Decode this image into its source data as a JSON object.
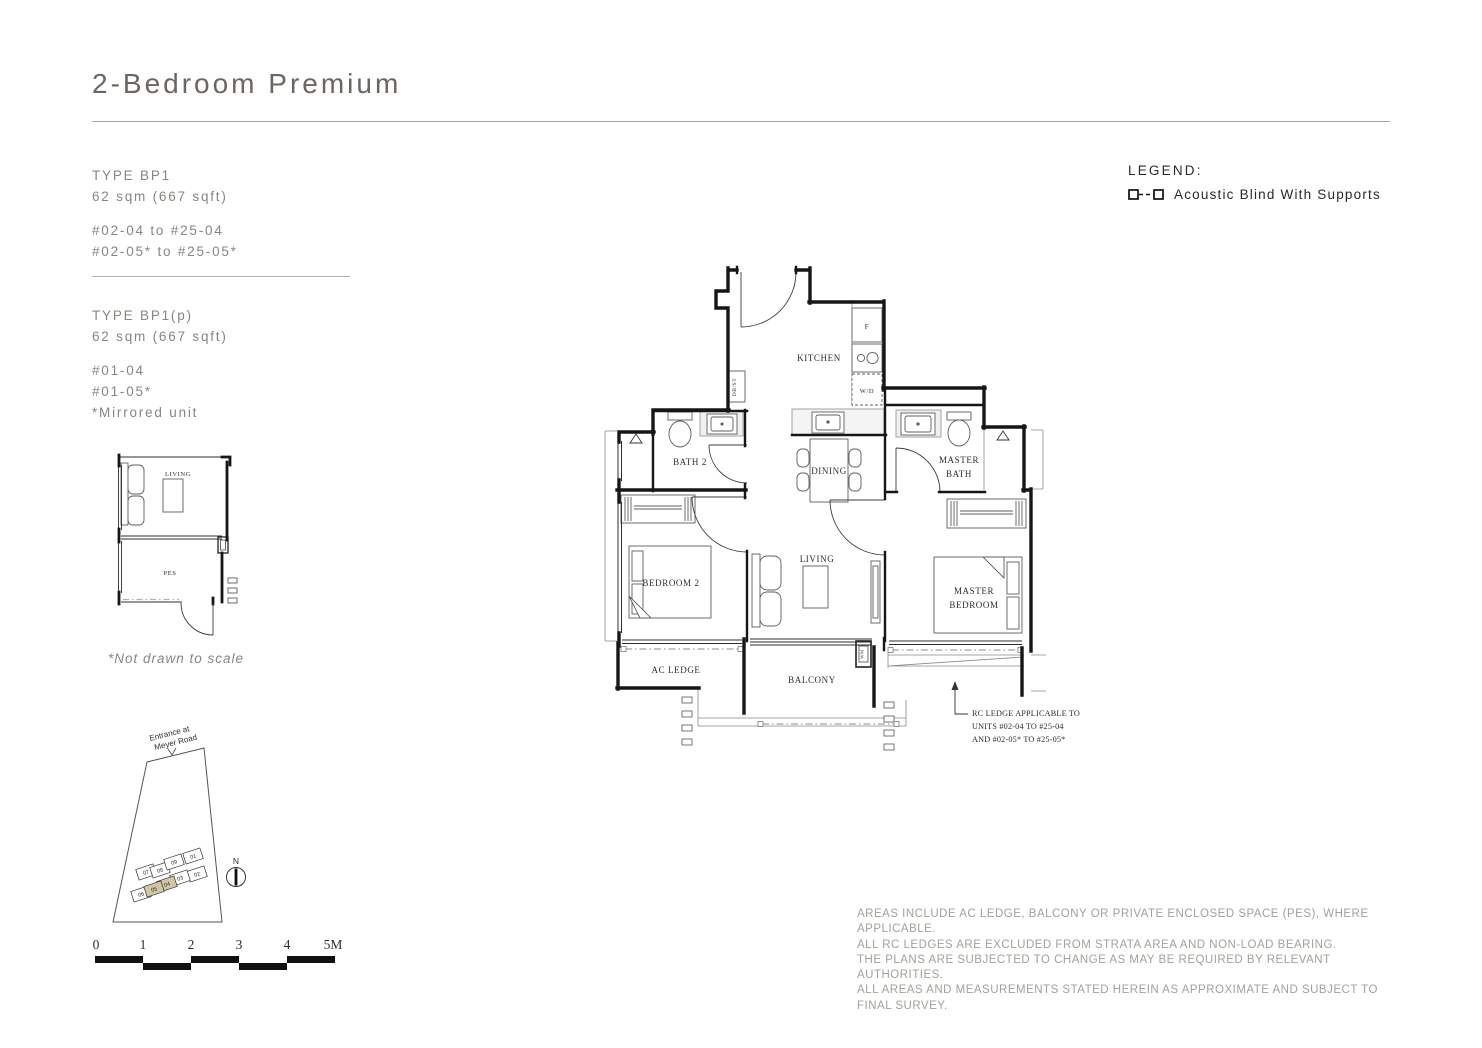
{
  "header": {
    "title": "2-Bedroom Premium"
  },
  "unit_types": [
    {
      "name": "TYPE BP1",
      "area": "62 sqm (667 sqft)",
      "units": [
        "#02-04 to #25-04",
        "#02-05* to #25-05*"
      ]
    },
    {
      "name": "TYPE BP1(p)",
      "area": "62 sqm (667 sqft)",
      "units": [
        "#01-04",
        "#01-05*"
      ],
      "note": "*Mirrored unit"
    }
  ],
  "legend": {
    "title": "LEGEND:",
    "item_label": "Acoustic Blind With Supports"
  },
  "floor_plan": {
    "rooms": {
      "kitchen": "KITCHEN",
      "bath2": "BATH 2",
      "dining": "DINING",
      "master_bath": [
        "MASTER",
        "BATH"
      ],
      "bedroom2": "BEDROOM 2",
      "living": "LIVING",
      "master_bedroom": [
        "MASTER",
        "BEDROOM"
      ],
      "ac_ledge": "AC LEDGE",
      "balcony": "BALCONY"
    },
    "fixtures": {
      "fridge": "F",
      "washer_dryer": "W/D",
      "db_st": "DB/ST",
      "wm": "WM"
    },
    "callout": {
      "lines": [
        "RC LEDGE APPLICABLE TO",
        "UNITS #02-04 TO #25-04",
        "AND #02-05* TO #25-05*"
      ]
    }
  },
  "inset_plan": {
    "living": "LIVING",
    "pes": "PES",
    "note": "*Not drawn to scale"
  },
  "site_plan": {
    "entrance": [
      "Entrance at",
      "Meyer Road"
    ],
    "compass": "N",
    "units": [
      "01",
      "02",
      "03",
      "04",
      "05",
      "06",
      "07",
      "08",
      "09"
    ],
    "highlighted": [
      "04",
      "05"
    ]
  },
  "scale_bar": {
    "labels": [
      "0",
      "1",
      "2",
      "3",
      "4",
      "5M"
    ]
  },
  "disclaimer": [
    "AREAS INCLUDE AC LEDGE, BALCONY OR PRIVATE ENCLOSED SPACE (PES), WHERE APPLICABLE.",
    "ALL RC LEDGES ARE EXCLUDED FROM STRATA AREA AND NON-LOAD BEARING.",
    "THE PLANS ARE SUBJECTED TO CHANGE AS MAY BE REQUIRED BY RELEVANT AUTHORITIES.",
    "ALL AREAS AND MEASUREMENTS STATED HEREIN AS APPROXIMATE AND SUBJECT TO FINAL SURVEY."
  ],
  "colors": {
    "highlight_unit": "#d3c6a7",
    "wall": "#161616",
    "muted_text": "#8b857f"
  }
}
